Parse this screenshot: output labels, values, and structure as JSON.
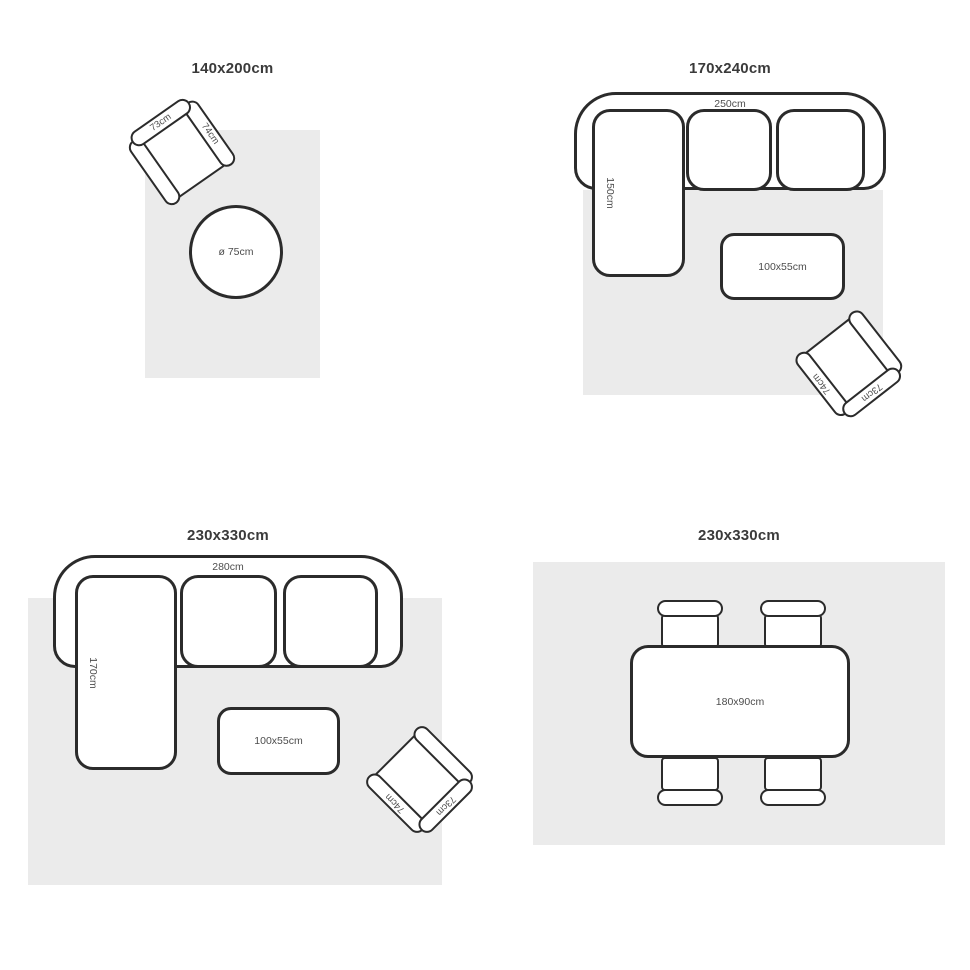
{
  "colors": {
    "rug": "#ebebeb",
    "outline": "#2b2b2b",
    "label": "#4d4d4d",
    "title": "#3a3a3a"
  },
  "panels": [
    {
      "title": "140x200cm",
      "round_table_label": "ø 75cm",
      "armchair": {
        "back_label": "73cm",
        "arm_label": "74cm"
      }
    },
    {
      "title": "170x240cm",
      "sofa": {
        "width_label": "250cm",
        "depth_label": "150cm"
      },
      "coffee_table_label": "100x55cm",
      "armchair": {
        "back_label": "73cm",
        "arm_label": "74cm"
      }
    },
    {
      "title": "230x330cm",
      "sofa": {
        "width_label": "280cm",
        "depth_label": "170cm"
      },
      "coffee_table_label": "100x55cm",
      "armchair": {
        "back_label": "73cm",
        "arm_label": "74cm"
      }
    },
    {
      "title": "230x330cm",
      "dining_table_label": "180x90cm"
    }
  ]
}
